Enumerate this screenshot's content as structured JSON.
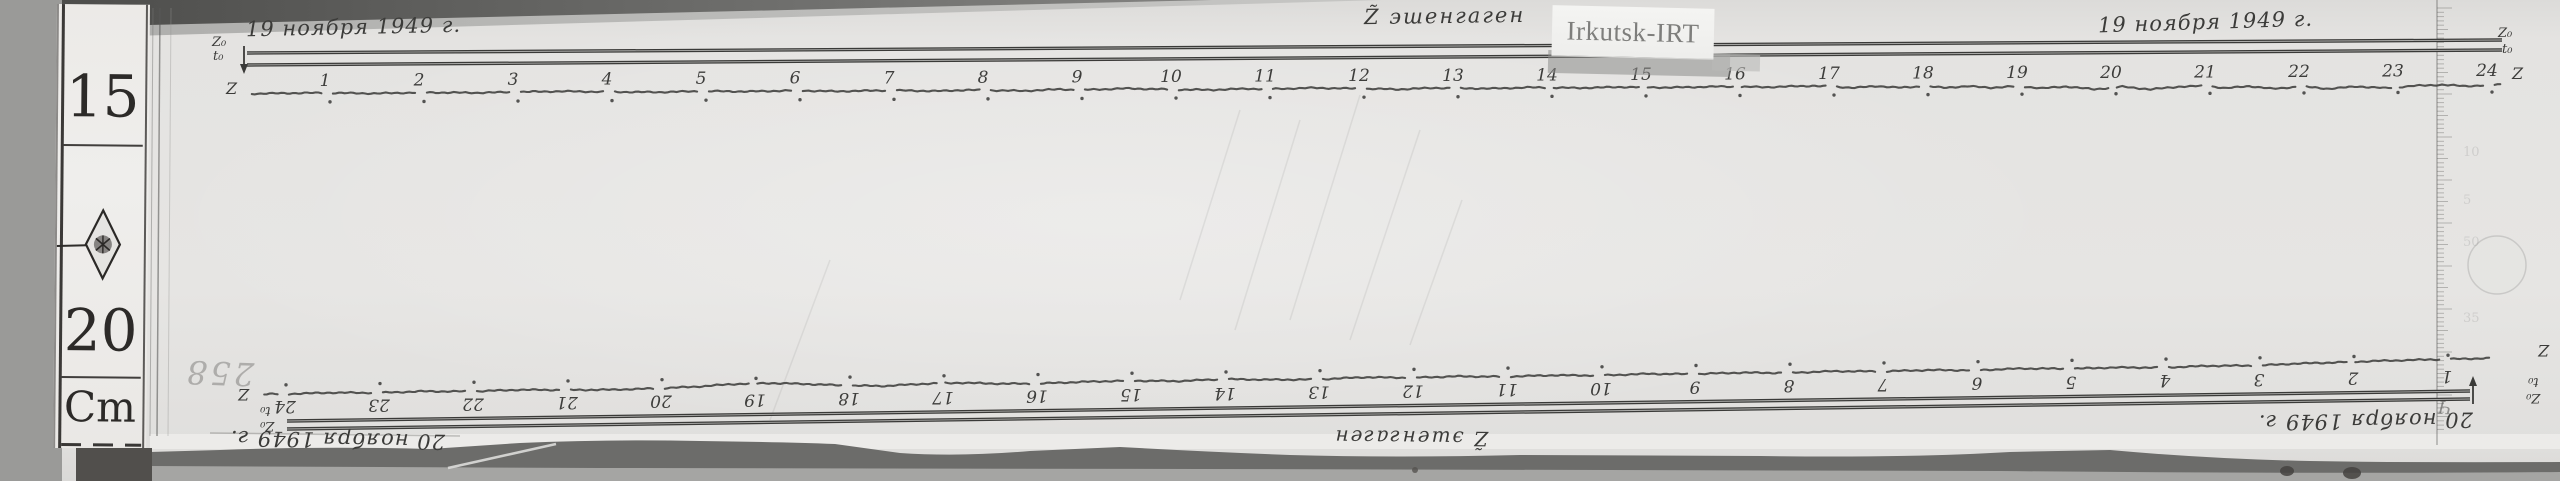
{
  "station_label": "Irkutsk-IRT",
  "pencil_note": "258",
  "left_scale": {
    "value_top": "15",
    "value_bottom": "20",
    "unit": "Cm"
  },
  "right_ruler": {
    "faint_numbers": [
      "10",
      "5",
      "50",
      "35"
    ]
  },
  "top_record": {
    "date_left": "19 ноября 1949 г.",
    "date_right": "19 ноября 1949 г.",
    "instrument": "Z̃ эшенгаген",
    "z0": "Z₀",
    "t0": "t₀",
    "z": "Z",
    "z0_right": "Z₀",
    "t0_right": "t₀",
    "z_right": "Z"
  },
  "bottom_record": {
    "date_left": "20 ноября 1949 г.",
    "date_right": "20 ноября 1949 г.",
    "instrument": "Z̃ эшенгаген",
    "z0": "Z₀",
    "t0": "t₀",
    "z": "Z",
    "z0_right": "Z₀",
    "t0_right": "t₀",
    "z_right": "Z",
    "stray_mark": "Ч"
  },
  "chart_data": [
    {
      "type": "line",
      "title": "Z component magnetogram trace — 19 November 1949 (Z̃ эшенгаген)",
      "station": "Irkutsk-IRT",
      "x_unit": "hour",
      "orientation": "normal",
      "trace_label": "Z",
      "baseline_labels": [
        "Z₀",
        "t₀"
      ],
      "categories": [
        "1",
        "2",
        "3",
        "4",
        "5",
        "6",
        "7",
        "8",
        "9",
        "10",
        "11",
        "12",
        "13",
        "14",
        "15",
        "16",
        "17",
        "18",
        "19",
        "20",
        "21",
        "22",
        "23",
        "24"
      ],
      "notes": "quiet trace hours 1–17, increasing disturbance hours 17–24; hour marks are small gaps with a dot below; double baseline (Z₀, t₀) runs above the trace",
      "points_hour_offset": [
        [
          0.2,
          0.5
        ],
        [
          0.7,
          0
        ],
        [
          1,
          0
        ],
        [
          1.5,
          0.8
        ],
        [
          2,
          0
        ],
        [
          2.6,
          0.6
        ],
        [
          3,
          0
        ],
        [
          3.5,
          -0.5
        ],
        [
          4,
          0.3
        ],
        [
          4.5,
          0.8
        ],
        [
          5,
          0
        ],
        [
          5.5,
          0.5
        ],
        [
          6,
          -0.3
        ],
        [
          6.4,
          0.8
        ],
        [
          7,
          0
        ],
        [
          7.5,
          1
        ],
        [
          7.8,
          0
        ],
        [
          8,
          0.3
        ],
        [
          8.4,
          1.2
        ],
        [
          8.8,
          -0.3
        ],
        [
          9,
          0.5
        ],
        [
          9.5,
          -0.8
        ],
        [
          10,
          0.5
        ],
        [
          10.4,
          1
        ],
        [
          10.8,
          0
        ],
        [
          11,
          0.5
        ],
        [
          11.5,
          -0.5
        ],
        [
          12,
          0.5
        ],
        [
          12.4,
          1.3
        ],
        [
          12.8,
          0
        ],
        [
          13,
          0.5
        ],
        [
          13.4,
          1
        ],
        [
          13.8,
          0
        ],
        [
          14.3,
          0.8
        ],
        [
          14.8,
          0
        ],
        [
          15.3,
          0.8
        ],
        [
          15.8,
          0
        ],
        [
          16.3,
          0.8
        ],
        [
          16.8,
          -0.3
        ],
        [
          17,
          0.5
        ],
        [
          17.25,
          1.8
        ],
        [
          17.5,
          0.3
        ],
        [
          17.75,
          2
        ],
        [
          18,
          0.5
        ],
        [
          18.2,
          2.2
        ],
        [
          18.45,
          0.8
        ],
        [
          18.7,
          2.4
        ],
        [
          19,
          1
        ],
        [
          19.25,
          3.2
        ],
        [
          19.5,
          1.5
        ],
        [
          19.8,
          4.5
        ],
        [
          20.1,
          2
        ],
        [
          20.4,
          4.8
        ],
        [
          20.7,
          2.2
        ],
        [
          21,
          1.5
        ],
        [
          21.2,
          4
        ],
        [
          21.45,
          2
        ],
        [
          21.7,
          4.8
        ],
        [
          22,
          2.5
        ],
        [
          22.3,
          5
        ],
        [
          22.6,
          2.8
        ],
        [
          22.9,
          4.6
        ],
        [
          23.2,
          2.5
        ],
        [
          23.5,
          1.5
        ],
        [
          23.75,
          3
        ],
        [
          24,
          2
        ],
        [
          24.15,
          1.5
        ]
      ]
    },
    {
      "type": "line",
      "title": "Z component magnetogram trace — 20 November 1949 (Z̃ эшенгаген, sheet rotated 180°)",
      "station": "Irkutsk-IRT",
      "x_unit": "hour",
      "orientation": "rotated_180",
      "trace_label": "Z",
      "baseline_labels": [
        "Z₀",
        "t₀"
      ],
      "categories": [
        "24",
        "23",
        "22",
        "21",
        "20",
        "19",
        "18",
        "17",
        "16",
        "15",
        "14",
        "13",
        "12",
        "11",
        "10",
        "9",
        "8",
        "7",
        "6",
        "5",
        "4",
        "3",
        "2",
        "1"
      ],
      "notes": "record mounted upside-down: hours run 24→1 left to right, numbers below the trace, dots above, double baseline (Z₀, t₀) below the trace; bulge near hours 19–18 and rise toward hour 1",
      "points_hour_offset": [
        [
          24.2,
          0
        ],
        [
          24,
          0.3
        ],
        [
          23.5,
          -0.5
        ],
        [
          23,
          0.3
        ],
        [
          22.5,
          -0.6
        ],
        [
          22,
          0.2
        ],
        [
          21.5,
          -0.8
        ],
        [
          21,
          0
        ],
        [
          20.5,
          0.4
        ],
        [
          20,
          -0.3
        ],
        [
          19.6,
          -1.5
        ],
        [
          19.2,
          -3.6
        ],
        [
          18.8,
          -4
        ],
        [
          18.4,
          -2.5
        ],
        [
          18,
          -0.5
        ],
        [
          17.6,
          0.4
        ],
        [
          17.2,
          -1.2
        ],
        [
          16.8,
          -1.8
        ],
        [
          16.4,
          -0.4
        ],
        [
          16,
          0.2
        ],
        [
          15.5,
          -1
        ],
        [
          15,
          -1.6
        ],
        [
          14.5,
          -0.4
        ],
        [
          14,
          -1.8
        ],
        [
          13.5,
          -0.6
        ],
        [
          13,
          -0.2
        ],
        [
          12.5,
          -1.8
        ],
        [
          12,
          -0.6
        ],
        [
          11.5,
          -1.4
        ],
        [
          11,
          -0.4
        ],
        [
          10.5,
          -1.2
        ],
        [
          10,
          -0.3
        ],
        [
          9.5,
          -1.3
        ],
        [
          9,
          -0.4
        ],
        [
          8.5,
          -1.2
        ],
        [
          8,
          -0.3
        ],
        [
          7.5,
          -1.4
        ],
        [
          7,
          -0.5
        ],
        [
          6.5,
          -1.2
        ],
        [
          6,
          -0.4
        ],
        [
          5.5,
          -1.5
        ],
        [
          5,
          -0.6
        ],
        [
          4.5,
          -1.2
        ],
        [
          4,
          -0.5
        ],
        [
          3.5,
          -1.6
        ],
        [
          3,
          -1.2
        ],
        [
          2.6,
          -2.6
        ],
        [
          2.2,
          -3.2
        ],
        [
          1.8,
          -4
        ],
        [
          1.4,
          -4.6
        ],
        [
          1,
          -5
        ],
        [
          0.5,
          -5.4
        ]
      ]
    }
  ]
}
